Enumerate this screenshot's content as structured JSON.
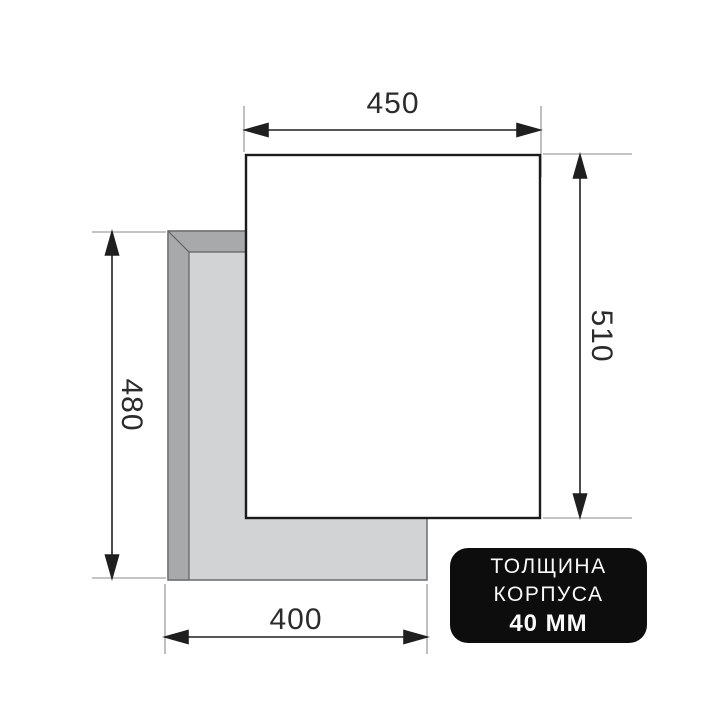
{
  "diagram": {
    "type": "appliance-cutout-installation-drawing",
    "dimensions": {
      "panel_width_top": "450",
      "panel_height_right": "510",
      "cutout_height_left": "480",
      "cutout_width_bottom": "400"
    },
    "badge": {
      "line1": "ТОЛЩИНА",
      "line2": "КОРПУСА",
      "line3": "40 ММ"
    },
    "colors": {
      "background": "#ffffff",
      "dimension_line": "#1f1f1f",
      "extension_line": "#b0b0b0",
      "panel_fill": "#ffffff",
      "panel_border": "#1b1b1b",
      "cutout_band": "#a7a9ab",
      "cutout_inner": "#d2d3d4",
      "cutout_edge": "#606264",
      "badge_background": "#0d0d0d",
      "badge_text": "#fafafa",
      "label_text": "#2b2b2b"
    }
  }
}
